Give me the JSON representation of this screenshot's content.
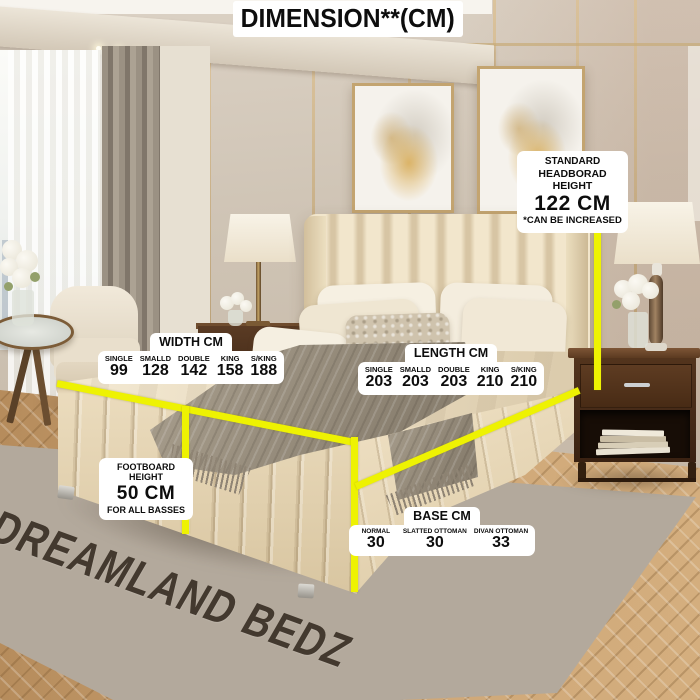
{
  "accent_color": "#eef202",
  "title": "DIMENSION**(CM)",
  "watermark": "DREAMLAND BEDZ",
  "headboard_label": {
    "line1": "STANDARD",
    "line2": "HEADBORAD HEIGHT",
    "value": "122 CM",
    "note": "*CAN BE INCREASED"
  },
  "footboard_label": {
    "line1": "FOOTBOARD HEIGHT",
    "value": "50 CM",
    "note": "FOR ALL BASSES"
  },
  "width_table": {
    "header": "WIDTH CM",
    "columns": [
      {
        "label": "SINGLE",
        "value": "99"
      },
      {
        "label": "SMALLD",
        "value": "128"
      },
      {
        "label": "DOUBLE",
        "value": "142"
      },
      {
        "label": "KING",
        "value": "158"
      },
      {
        "label": "S/KING",
        "value": "188"
      }
    ]
  },
  "length_table": {
    "header": "LENGTH CM",
    "columns": [
      {
        "label": "SINGLE",
        "value": "203"
      },
      {
        "label": "SMALLD",
        "value": "203"
      },
      {
        "label": "DOUBLE",
        "value": "203"
      },
      {
        "label": "KING",
        "value": "210"
      },
      {
        "label": "S/KING",
        "value": "210"
      }
    ]
  },
  "base_table": {
    "header": "BASE CM",
    "columns": [
      {
        "label": "NORMAL",
        "value": "30"
      },
      {
        "label": "SLATTED OTTOMAN",
        "value": "30"
      },
      {
        "label": "DIVAN OTTOMAN",
        "value": "33"
      }
    ]
  }
}
